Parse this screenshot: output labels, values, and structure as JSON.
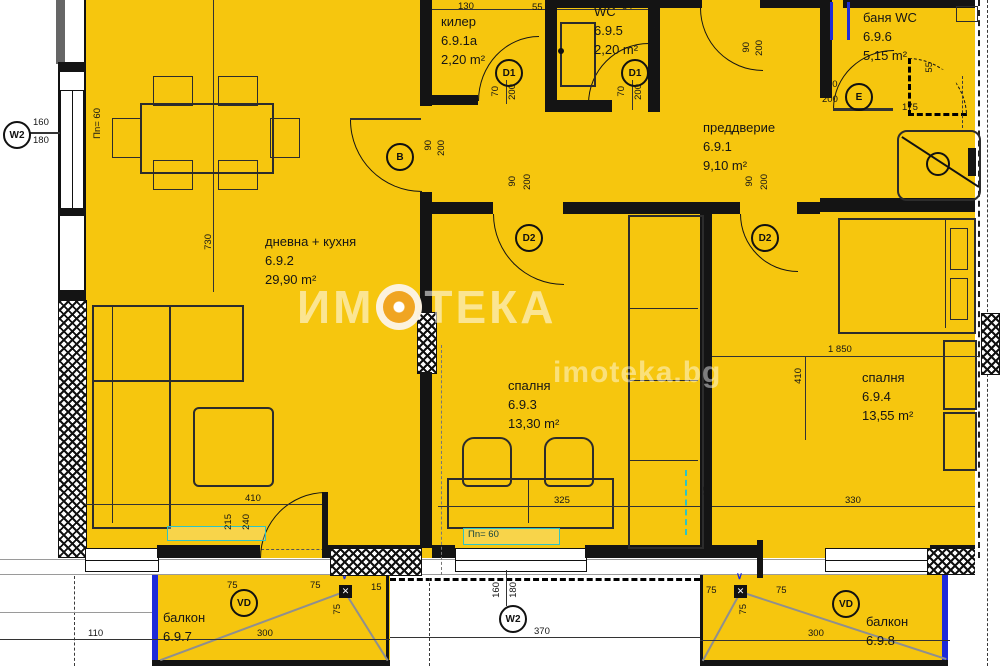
{
  "watermark": {
    "brand": "ИМОТЕКА",
    "brand_left": "ИМ",
    "brand_right": "ТЕКА",
    "site": "imoteka.bg"
  },
  "rooms": {
    "killer": {
      "name": "килер",
      "number": "6.9.1а",
      "area": "2,20 m²"
    },
    "wc": {
      "name": "WC",
      "number": "6.9.5",
      "area": "2,20 m²"
    },
    "bath": {
      "name": "баня WC",
      "number": "6.9.6",
      "area": "5,15 m²"
    },
    "hall": {
      "name": "преддверие",
      "number": "6.9.1",
      "area": "9,10 m²"
    },
    "living": {
      "name": "дневна + кухня",
      "number": "6.9.2",
      "area": "29,90 m²"
    },
    "bedroom1": {
      "name": "спалня",
      "number": "6.9.3",
      "area": "13,30 m²"
    },
    "bedroom2": {
      "name": "спалня",
      "number": "6.9.4",
      "area": "13,55 m²"
    },
    "balcony1": {
      "name": "балкон",
      "number": "6.9.7"
    },
    "balcony2": {
      "name": "балкон",
      "number": "6.9.8"
    }
  },
  "markers": {
    "window": "W2",
    "b": "B",
    "d1": "D1",
    "d2": "D2",
    "e": "E",
    "vd": "VD",
    "x": "✕",
    "v": "∨"
  },
  "dims": {
    "n130": "130",
    "n55": "55",
    "n84": "84",
    "n170": "170",
    "n70": "70",
    "n200": "200",
    "n90": "90",
    "n160": "160",
    "n180": "180",
    "n730": "730",
    "n410": "410",
    "n215": "215",
    "n240": "240",
    "n325": "325",
    "n15": "15",
    "n1850": "1 850",
    "n330": "330",
    "n110": "110",
    "n300": "300",
    "n370": "370",
    "n75": "75",
    "n175": "175",
    "pn60": "Пn= 60"
  },
  "colors": {
    "plan": "#F6C60E",
    "wall": "#141414",
    "balcony_edge": "#1E2BD9",
    "accent": "#2FC4C4",
    "watermark_circle": "#F0A124"
  }
}
